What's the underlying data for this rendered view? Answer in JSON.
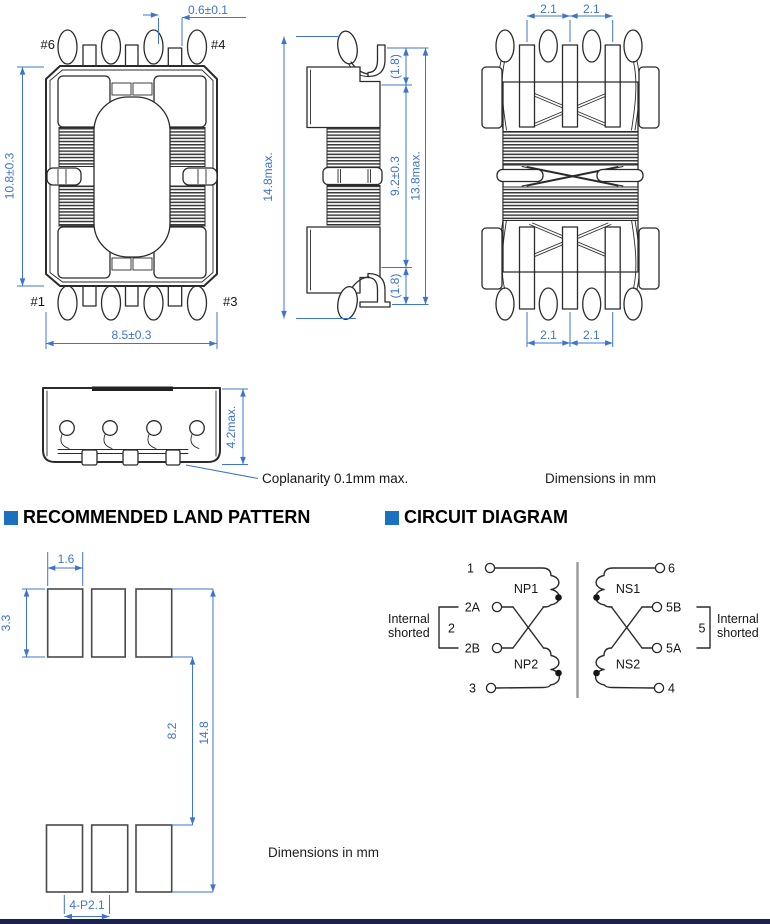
{
  "colors": {
    "dim": "#3E74CC",
    "line": "#2b2b2b",
    "header_square": "#1C70C0",
    "footer_bar": "#1B2150",
    "core": "#999999"
  },
  "headers": {
    "land_pattern": "RECOMMENDED LAND PATTERN",
    "circuit_diagram": "CIRCUIT DIAGRAM"
  },
  "notes": {
    "dimensions_top": "Dimensions in mm",
    "dimensions_bottom": "Dimensions in mm",
    "coplanarity": "Coplanarity 0.1mm max."
  },
  "views": {
    "front": {
      "pin_top_left": "#6",
      "pin_top_right": "#4",
      "pin_bottom_left": "#1",
      "pin_bottom_right": "#3",
      "dim_terminal_width": "0.6±0.1",
      "dim_height": "10.8±0.3",
      "dim_width": "8.5±0.3"
    },
    "side": {
      "dim_overall_height": "14.8max.",
      "dim_lead_top": "(1.8)",
      "dim_body_height": "9.2±0.3",
      "dim_lead_bottom": "(1.8)",
      "dim_height_with_leads": "13.8max."
    },
    "rear": {
      "dim_pitch_top_left": "2.1",
      "dim_pitch_top_right": "2.1",
      "dim_pitch_bottom_left": "2.1",
      "dim_pitch_bottom_right": "2.1"
    },
    "profile": {
      "dim_height": "4.2max."
    }
  },
  "land_pattern": {
    "dim_pad_width": "1.6",
    "dim_pad_height": "3.3",
    "dim_row_gap": "8.2",
    "dim_overall": "14.8",
    "dim_pitch": "4-P2.1"
  },
  "circuit": {
    "terminals": {
      "t1": "1",
      "t2a": "2A",
      "t2b": "2B",
      "t3": "3",
      "t6": "6",
      "t5b": "5B",
      "t5a": "5A",
      "t4": "4"
    },
    "windings": {
      "np1": "NP1",
      "np2": "NP2",
      "ns1": "NS1",
      "ns2": "NS2"
    },
    "shorted_left": {
      "line1": "Internal",
      "line2": "shorted",
      "group": "2"
    },
    "shorted_right": {
      "line1": "Internal",
      "line2": "shorted",
      "group": "5"
    }
  }
}
